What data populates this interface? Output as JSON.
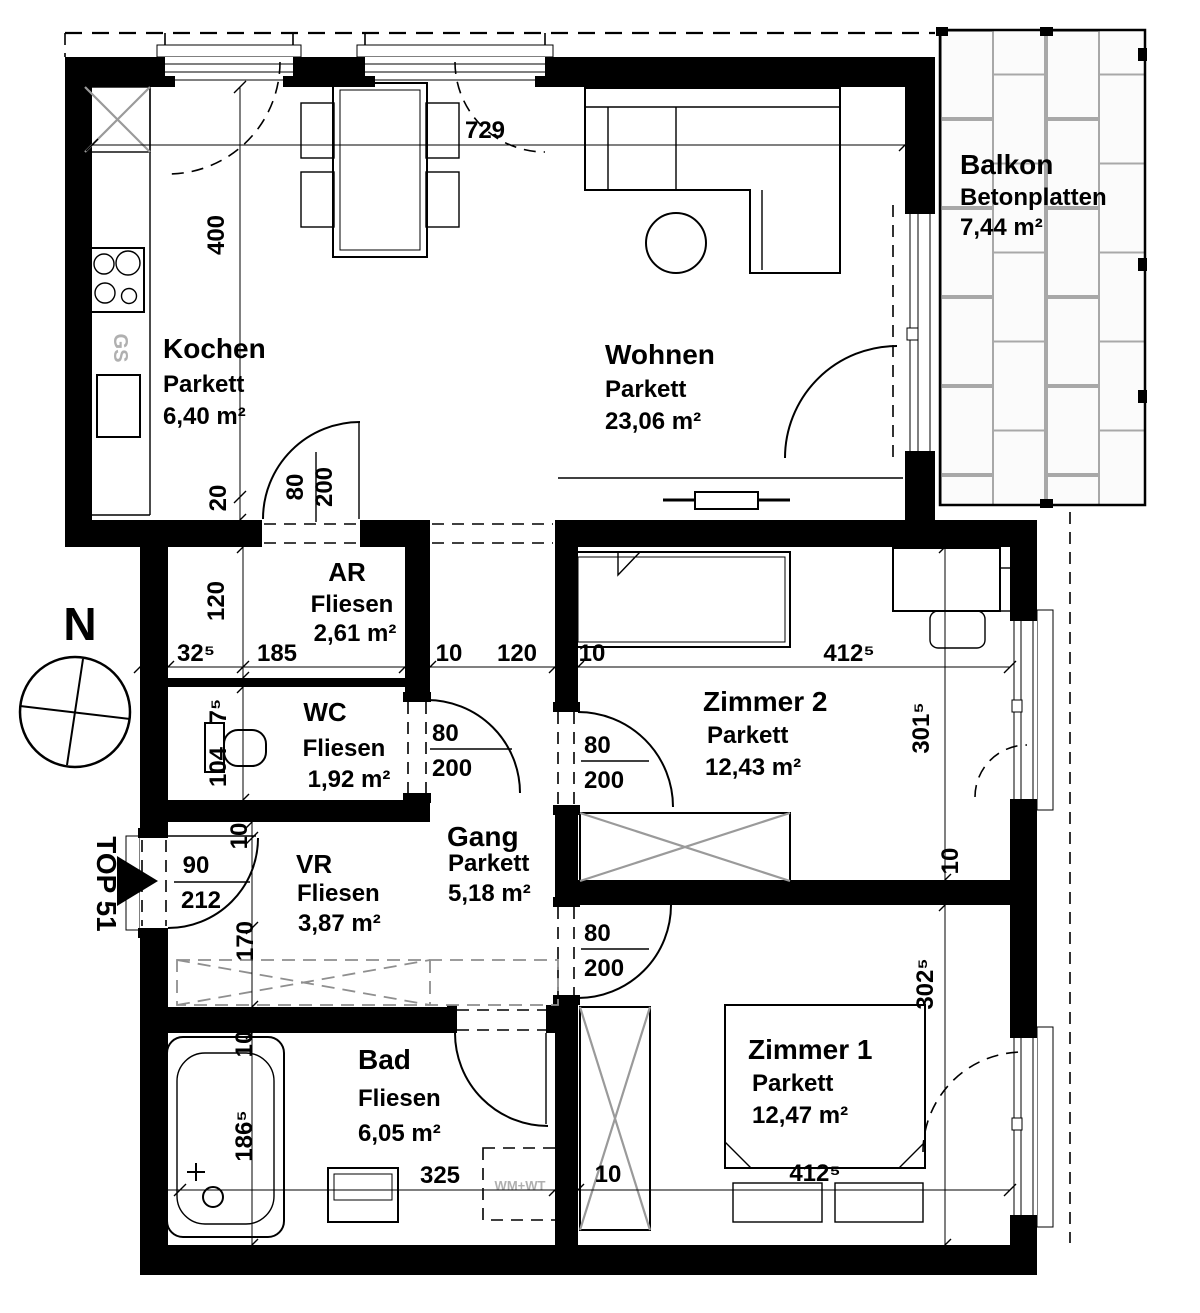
{
  "labels": {
    "unit": "TOP 51",
    "north": "N",
    "dishwasher": "GS",
    "washer_dryer": "WM+WT"
  },
  "rooms": {
    "kochen": {
      "name": "Kochen",
      "floor": "Parkett",
      "area": "6,40 m²"
    },
    "wohnen": {
      "name": "Wohnen",
      "floor": "Parkett",
      "area": "23,06 m²"
    },
    "balkon": {
      "name": "Balkon",
      "floor": "Betonplatten",
      "area": "7,44 m²"
    },
    "ar": {
      "name": "AR",
      "floor": "Fliesen",
      "area": "2,61 m²"
    },
    "wc": {
      "name": "WC",
      "floor": "Fliesen",
      "area": "1,92 m²"
    },
    "zimmer2": {
      "name": "Zimmer 2",
      "floor": "Parkett",
      "area": "12,43 m²"
    },
    "gang": {
      "name": "Gang",
      "floor": "Parkett",
      "area": "5,18 m²"
    },
    "vr": {
      "name": "VR",
      "floor": "Fliesen",
      "area": "3,87 m²"
    },
    "bad": {
      "name": "Bad",
      "floor": "Fliesen",
      "area": "6,05 m²"
    },
    "zimmer1": {
      "name": "Zimmer 1",
      "floor": "Parkett",
      "area": "12,47 m²"
    }
  },
  "dims": {
    "width_total": "729",
    "kitchen_height": "400",
    "counter": "20",
    "ar_height": "120",
    "ar_offset": "32⁵",
    "ar_width": "185",
    "wall": "10",
    "opening_gang": "120",
    "z2_width": "412⁵",
    "z2_height": "301⁵",
    "wc_wall": "7⁵",
    "wc_width": "104",
    "vr_height": "170",
    "tub_length": "186⁵",
    "bad_width": "325",
    "z1_width": "412⁵",
    "z1_height": "302⁵"
  },
  "doors": {
    "leaf": "80",
    "height": "200",
    "entry_leaf": "90",
    "entry_height": "212"
  },
  "colors": {
    "wall": "#000000",
    "tile_joint": "#a8a8a8",
    "furniture_cross": "#9a9a9a",
    "gray_text": "#b0b0b0"
  }
}
